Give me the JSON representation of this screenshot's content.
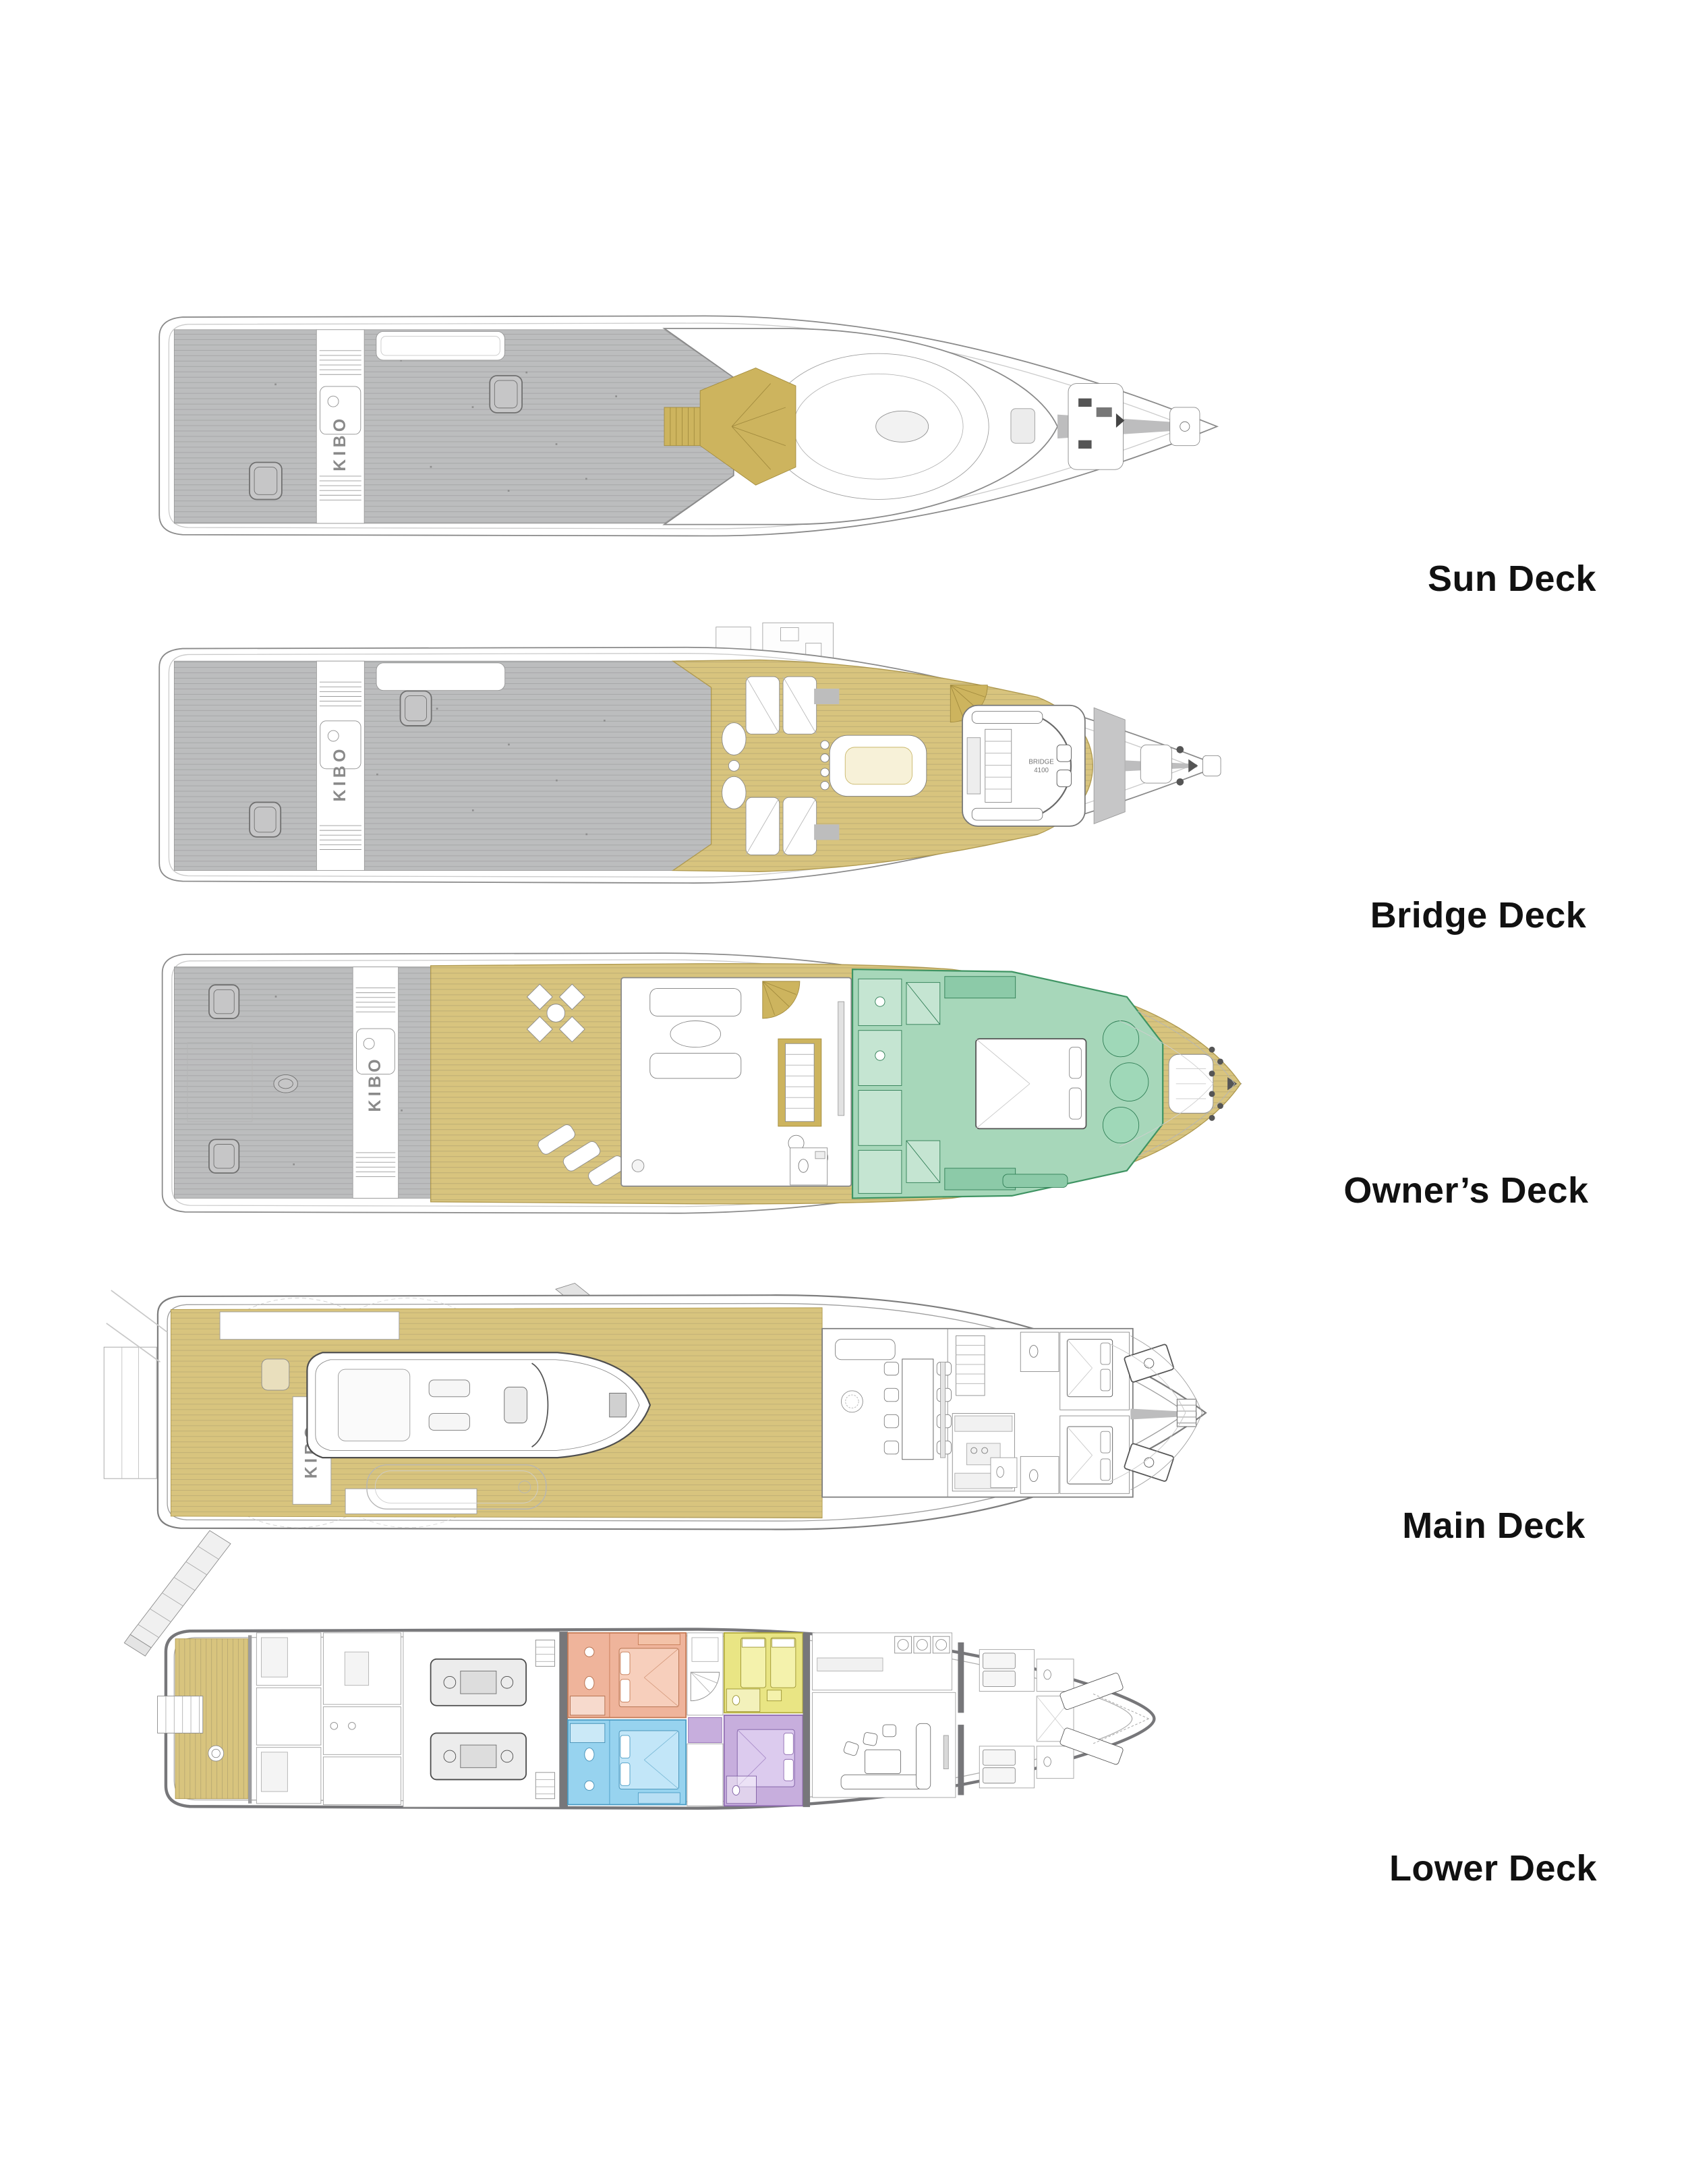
{
  "page": {
    "background": "#ffffff"
  },
  "vessel": {
    "hull_marking": "KIBO"
  },
  "decks": [
    {
      "id": "sun-deck",
      "label": "Sun Deck"
    },
    {
      "id": "bridge-deck",
      "label": "Bridge Deck",
      "rooms": {
        "bridge": {
          "name": "BRIDGE",
          "number": "4100"
        }
      }
    },
    {
      "id": "owners-deck",
      "label": "Owner’s Deck"
    },
    {
      "id": "main-deck",
      "label": "Main Deck"
    },
    {
      "id": "lower-deck",
      "label": "Lower Deck"
    }
  ],
  "colors": {
    "teak_gray": "#bcbdbe",
    "walk_gray": "#c6c6c7",
    "deck_tan": "#d8c47e",
    "stair_gold": "#cdb45e",
    "owner_green": "#a7d7ba",
    "cabin_salmon": "#efb49b",
    "cabin_yellow": "#e9e584",
    "cabin_blue": "#97d3ef",
    "cabin_purple": "#c7aedd",
    "hull_wall_gray": "#77777a",
    "label_text": "#111111"
  }
}
